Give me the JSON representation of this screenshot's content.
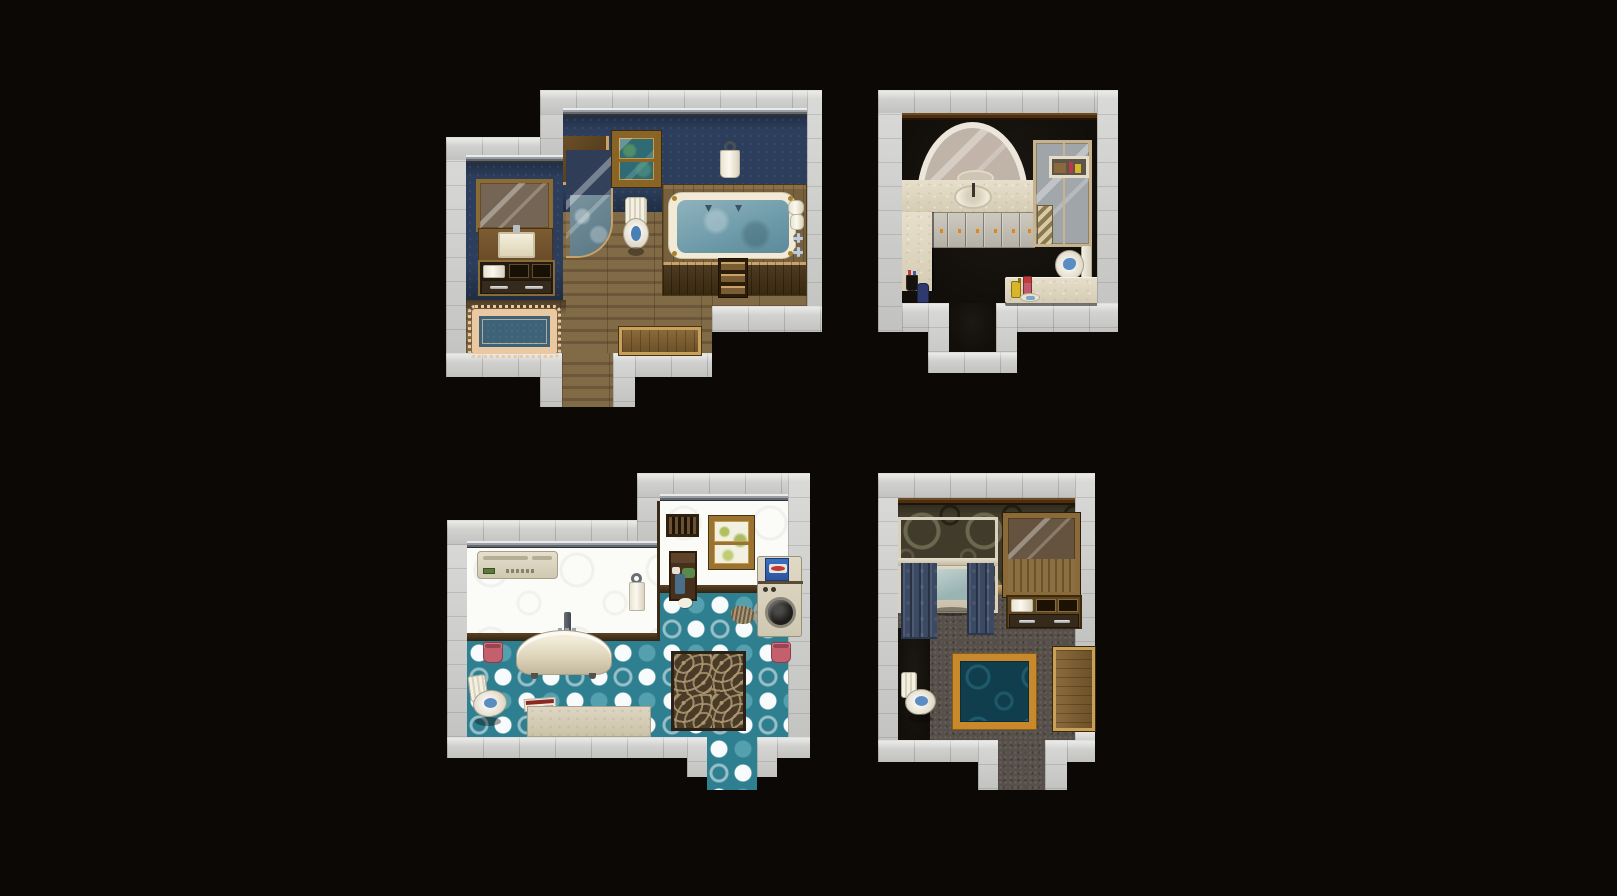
{
  "scene": {
    "name": "tilemap-bathroom-rooms",
    "description": "Four RPG-style bathroom interior maps on a black canvas",
    "room_count": 4,
    "background_color": "#0c0805",
    "wall_color": "#cbcbc9"
  },
  "rooms": [
    {
      "id": "top-left",
      "label": "Navy and wood bathroom",
      "wallpaper_color": "#2c3e5c",
      "floor_color": "#77603f",
      "objects": [
        "vanity-mirror",
        "sink-counter",
        "towel-shelf",
        "drawers",
        "shower-stall",
        "window",
        "toilet",
        "hanging-towel-ring",
        "bathtub-platform",
        "bathtub",
        "platform-steps",
        "towel-rolls",
        "wall-faucet-handles",
        "blue-rug",
        "wooden-mat",
        "south-doorway"
      ]
    },
    {
      "id": "top-right",
      "label": "Marble and dark bathroom",
      "floor_color": "#17130e",
      "counter_color": "#ded5c0",
      "objects": [
        "arched-mirror",
        "oval-sink",
        "marble-counter",
        "cabinet-doors",
        "side-counter",
        "toothbrush-cup",
        "blue-bottle",
        "shower-cabin",
        "shower-shelf",
        "step-ladder",
        "toilet",
        "low-counter",
        "yellow-bottle",
        "pink-bottle",
        "soap-dish",
        "south-doorway"
      ]
    },
    {
      "id": "bottom-left",
      "label": "White and teal polka-dot bathroom",
      "wall_color": "#fbfbf8",
      "floor_color": "#2e7f90",
      "objects": [
        "air-conditioner",
        "hanging-towel-ring",
        "clawfoot-bathtub",
        "bath-faucet",
        "pink-bucket-left",
        "pink-bucket-right",
        "toilet",
        "newspaper",
        "floor-mat",
        "swirl-rug",
        "laundry-shelf",
        "dropped-cloth",
        "vent-grate",
        "window",
        "mop",
        "mop-bucket",
        "washing-machine",
        "detergent-box",
        "south-doorway"
      ]
    },
    {
      "id": "bottom-right",
      "label": "Dark spa bathroom",
      "wallpaper_color": "#403b2a",
      "floor_color": "#57504a",
      "objects": [
        "curtained-bathtub",
        "shower-curtain-left",
        "shower-curtain-right",
        "curtain-rod",
        "curtain-hooks",
        "mirror-cabinet",
        "towel-shelf",
        "drawers",
        "teal-rug",
        "toilet",
        "wooden-mat-east",
        "south-doorway"
      ]
    }
  ],
  "palette": {
    "wall_gray": "#cbcbc9",
    "navy_wallpaper": "#2c3e5c",
    "wood_floor": "#77603f",
    "black_floor": "#17130e",
    "marble": "#ded5c0",
    "white_wall": "#fbfbf8",
    "teal_floor": "#2e7f90",
    "teal_dot_light": "#55a0ae",
    "olive_wallpaper": "#403b2a",
    "carpet_gray": "#57504a",
    "curtain_blue": "#3e4d68",
    "rug_navy": "#3e6277",
    "rug_border_tan": "#e9c8a2",
    "rug_teal": "#113e4d",
    "rug_border_gold": "#c8892c",
    "knob_orange": "#e0861f",
    "water_blue": "#7da6b5",
    "bucket_pink": "#c4606e",
    "wood_furniture": "#8a6a35"
  }
}
